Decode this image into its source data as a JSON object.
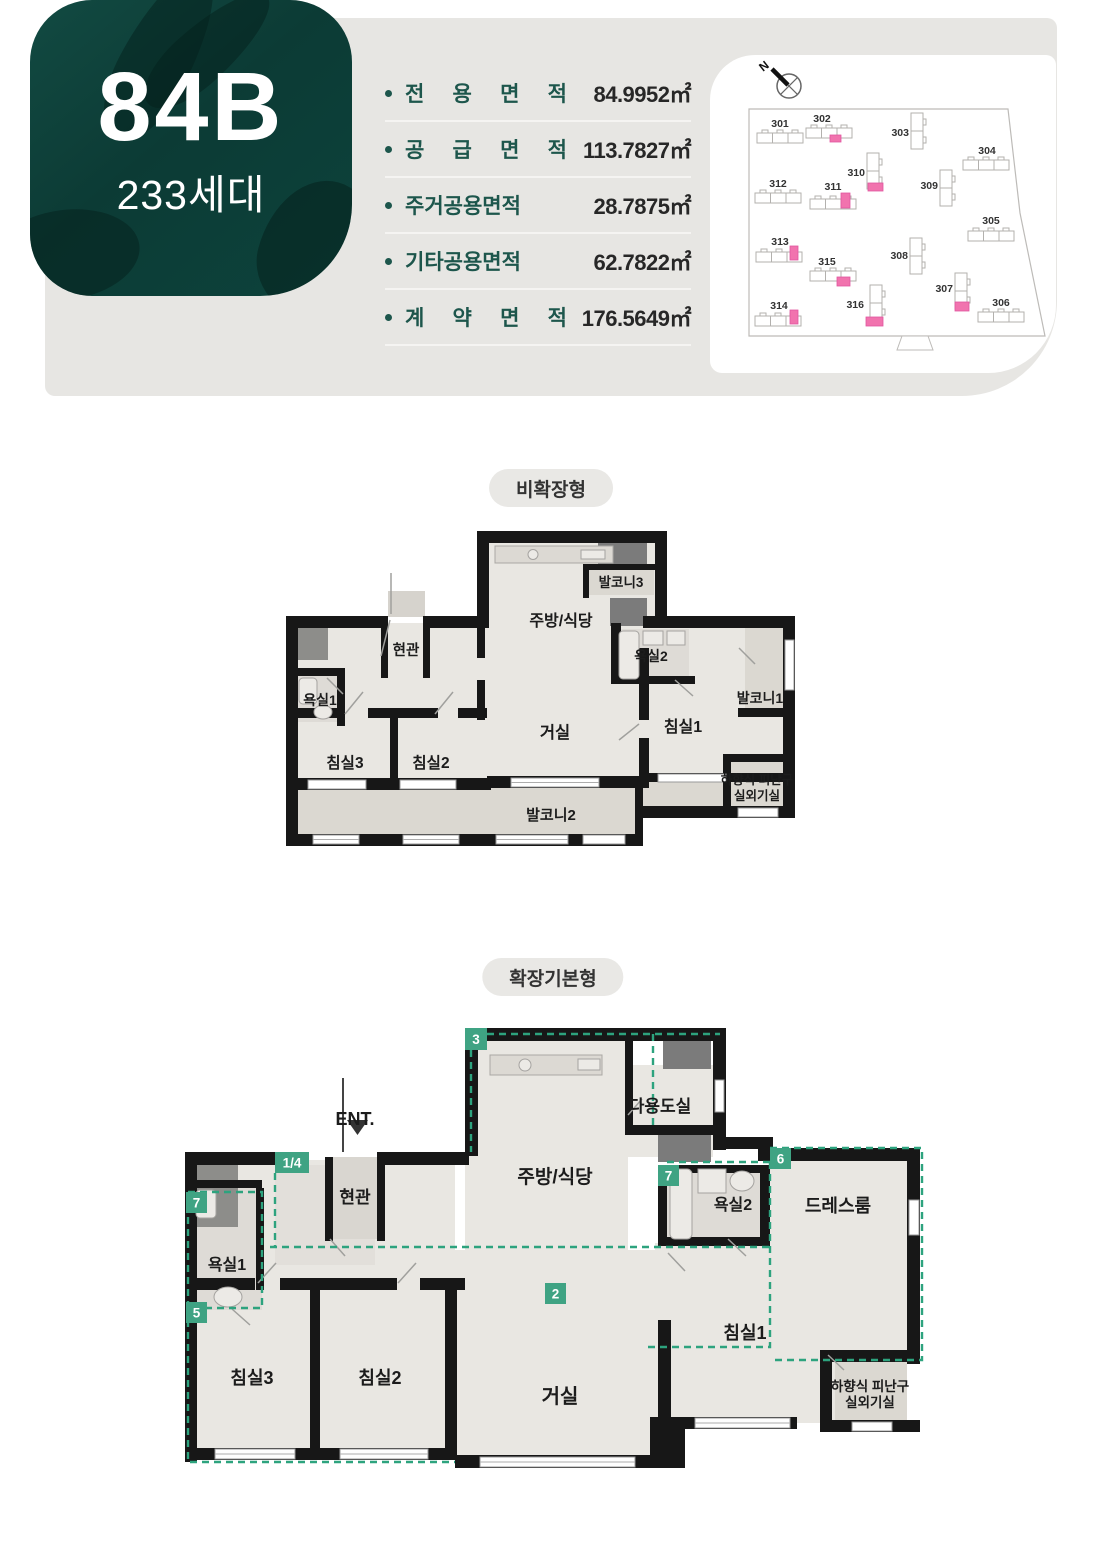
{
  "header": {
    "unit_code": "84B",
    "unit_households": "233세대",
    "area_rows": [
      {
        "label": "전 용 면 적",
        "value": "84.9952㎡"
      },
      {
        "label": "공 급 면 적",
        "value": "113.7827㎡"
      },
      {
        "label": "주거공용면적",
        "value": "28.7875㎡"
      },
      {
        "label": "기타공용면적",
        "value": "62.7822㎡"
      },
      {
        "label": "계 약 면 적",
        "value": "176.5649㎡"
      }
    ],
    "site_map": {
      "north_label": "N",
      "highlight_color": "#f173ae",
      "buildings": [
        {
          "no": "301",
          "highlighted": false
        },
        {
          "no": "302",
          "highlighted": true
        },
        {
          "no": "303",
          "highlighted": false
        },
        {
          "no": "304",
          "highlighted": false
        },
        {
          "no": "305",
          "highlighted": false
        },
        {
          "no": "306",
          "highlighted": false
        },
        {
          "no": "307",
          "highlighted": true
        },
        {
          "no": "308",
          "highlighted": false
        },
        {
          "no": "309",
          "highlighted": false
        },
        {
          "no": "310",
          "highlighted": true
        },
        {
          "no": "311",
          "highlighted": true
        },
        {
          "no": "312",
          "highlighted": false
        },
        {
          "no": "313",
          "highlighted": true
        },
        {
          "no": "314",
          "highlighted": true
        },
        {
          "no": "315",
          "highlighted": true
        },
        {
          "no": "316",
          "highlighted": true
        }
      ]
    }
  },
  "plan1": {
    "title": "비확장형",
    "labels": {
      "kitchen": "주방/식당",
      "balcony3": "발코니3",
      "entrance": "현관",
      "bath1": "욕실1",
      "bath2": "욕실2",
      "balcony1": "발코니1",
      "living": "거실",
      "bed1": "침실1",
      "bed2": "침실2",
      "bed3": "침실3",
      "balcony2": "발코니2",
      "evac1": "하향식 피난구",
      "evac2": "실외기실"
    }
  },
  "plan2": {
    "title": "확장기본형",
    "ent": "ENT.",
    "labels": {
      "kitchen": "주방/식당",
      "utility": "다용도실",
      "entrance": "현관",
      "bath1": "욕실1",
      "bath2": "욕실2",
      "dress": "드레스룸",
      "living": "거실",
      "bed1": "침실1",
      "bed2": "침실2",
      "bed3": "침실3",
      "evac1": "하향식 피난구",
      "evac2": "실외기실"
    },
    "badges": {
      "kitchen": "3",
      "entry": "1/4",
      "bath1": "7",
      "bath2": "7",
      "dress": "6",
      "bed3": "5",
      "living": "2"
    }
  },
  "colors": {
    "teal_card": "#0d3f39",
    "accent_teal": "#1d564c",
    "band_gray": "#e7e6e3",
    "badge_green": "#3fa383",
    "dash_green": "#2da37e",
    "highlight_pink": "#f173ae"
  }
}
